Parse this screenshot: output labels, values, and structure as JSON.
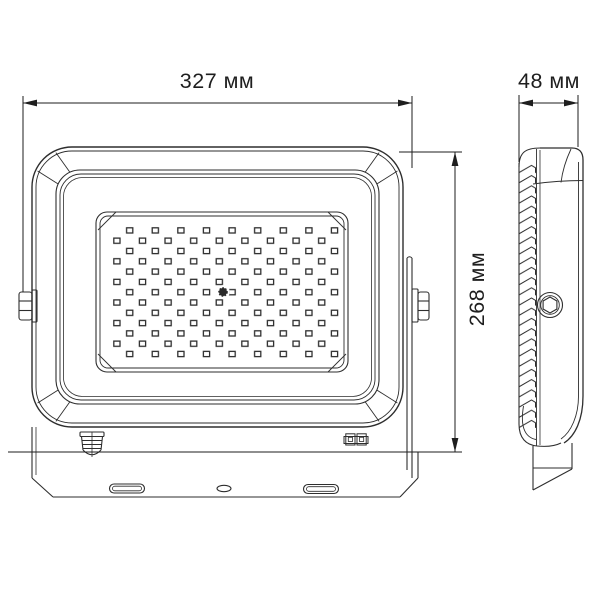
{
  "meta": {
    "type": "technical dimension drawing",
    "subject": "LED floodlight, front and side orthographic views",
    "unit": "мм"
  },
  "dimensions": {
    "width": {
      "label": "327 мм",
      "value": 327,
      "unit": "мм",
      "view": "front",
      "axis": "horizontal"
    },
    "depth": {
      "label": "48 мм",
      "value": 48,
      "unit": "мм",
      "view": "side",
      "axis": "horizontal"
    },
    "height": {
      "label": "268 мм",
      "value": 268,
      "unit": "мм",
      "view": "front",
      "axis": "vertical"
    }
  },
  "views": {
    "front": {
      "name": "front view",
      "features": [
        "led-panel",
        "center-screw",
        "cable-gland",
        "terminal-clip",
        "mounting-bracket-bar",
        "bracket-slots",
        "side-bolts"
      ]
    },
    "side": {
      "name": "side view",
      "features": [
        "heatsink-fins",
        "pivot-bolt",
        "bracket-arm"
      ]
    }
  },
  "led_grid": {
    "rows": 13,
    "columns_per_row": 9,
    "stagger": true
  },
  "bracket_slots": {
    "count": 3,
    "shapes": [
      "slot",
      "hole",
      "slot"
    ]
  },
  "colors": {
    "background": "#ffffff",
    "drawing_line": "#2e2e2e",
    "dimension_line": "#1e1e1e"
  }
}
